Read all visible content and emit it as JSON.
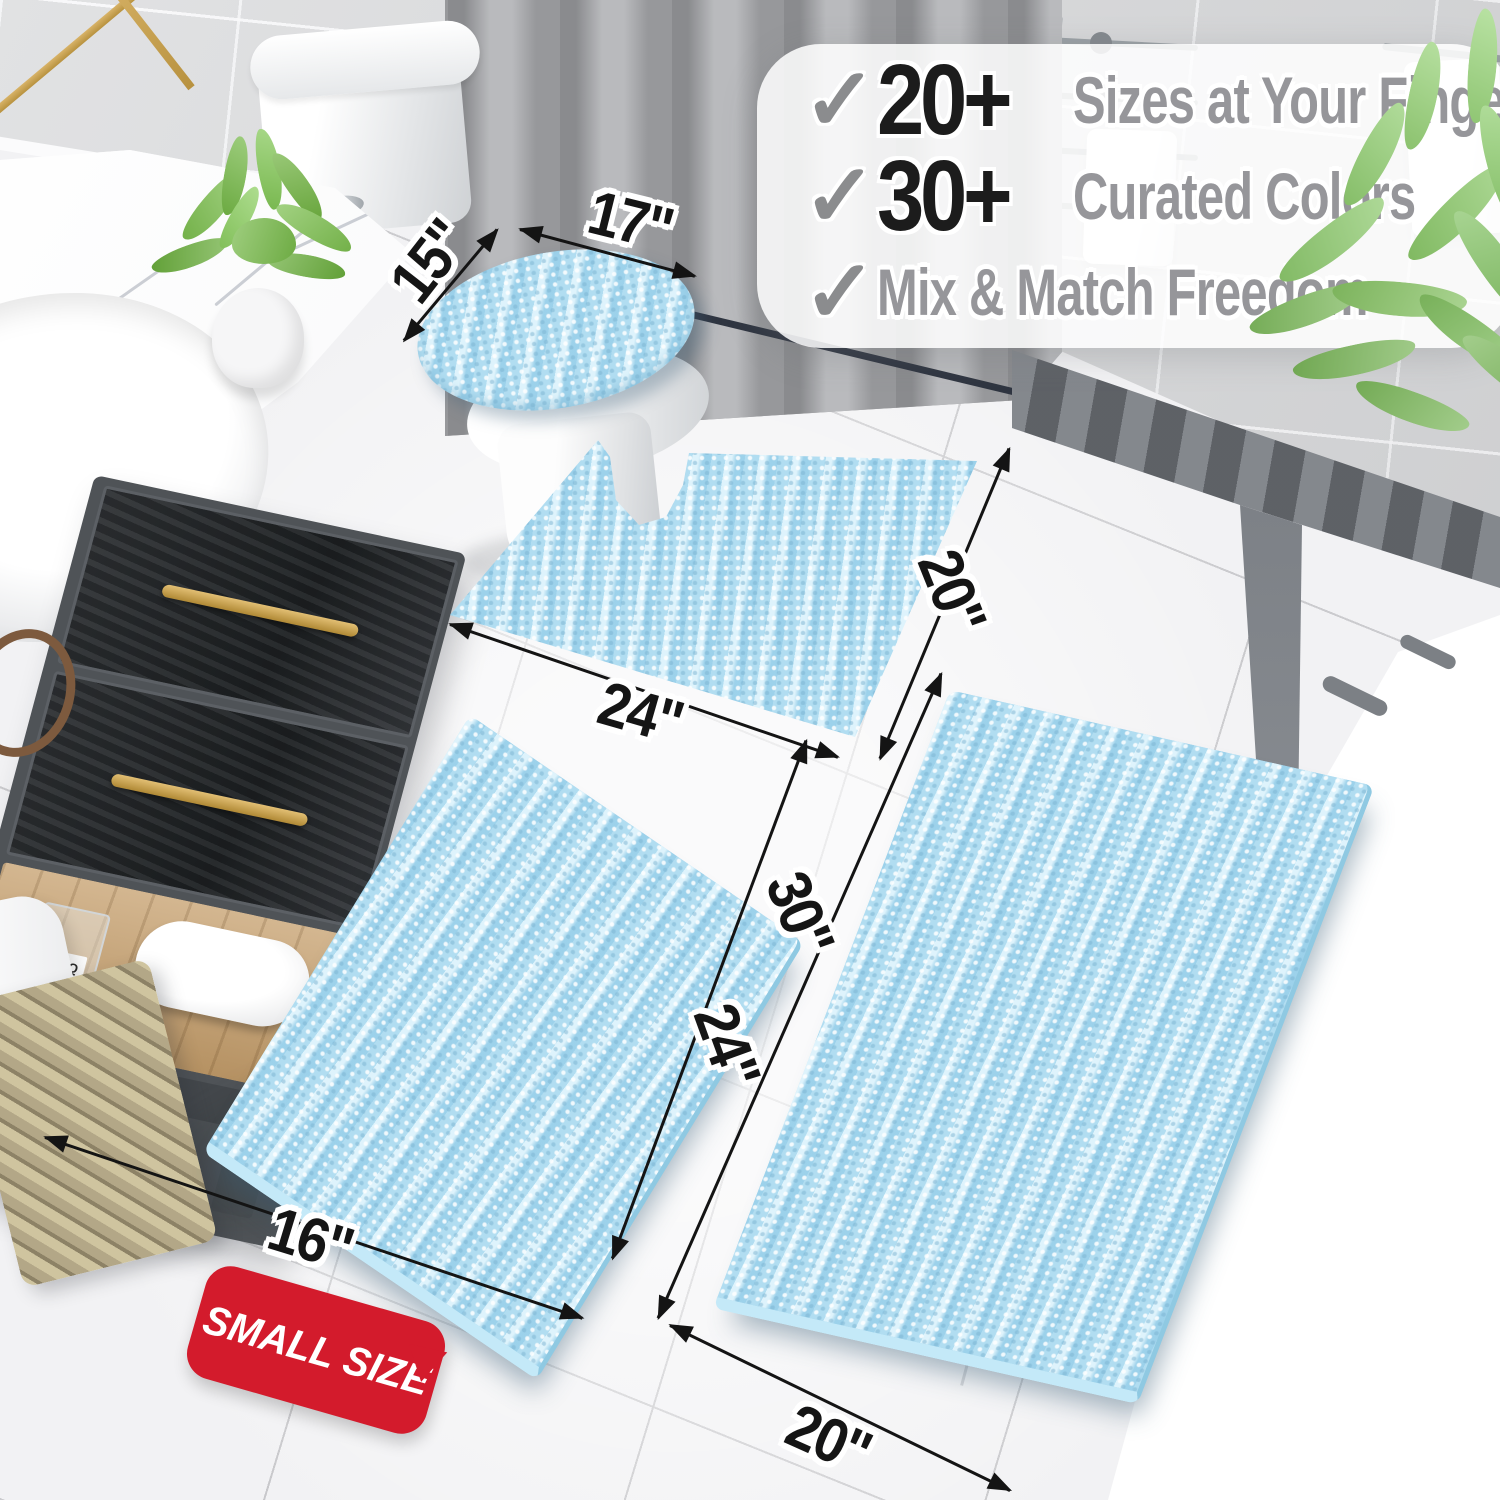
{
  "banner": {
    "items": [
      {
        "check": "✓",
        "number": "20+",
        "label": "Sizes at Your Fingertips"
      },
      {
        "check": "✓",
        "number": "30+",
        "label": "Curated Colors"
      },
      {
        "check": "✓",
        "number": "",
        "label": "Mix & Match Freedom"
      }
    ]
  },
  "dimensions": {
    "lid_width": "15\"",
    "lid_length": "17\"",
    "contour_width": "24\"",
    "contour_depth": "20\"",
    "small_rug_length": "24\"",
    "large_rug_length": "30\"",
    "small_rug_width": "16\"",
    "large_rug_width": "20\""
  },
  "badge": {
    "label": "SMALL SIZE"
  },
  "scene": {
    "perfume_label": "MISQ"
  },
  "colors": {
    "rug_blue": "#a7d8ee",
    "badge_red": "#d31b2c",
    "gold": "#c9a254",
    "wall_gray": "#d7d8da",
    "floor_white": "#f2f2f4",
    "leaf_green": "#84c365",
    "annotation_black": "#141414",
    "banner_text_gray": "#96969a"
  }
}
